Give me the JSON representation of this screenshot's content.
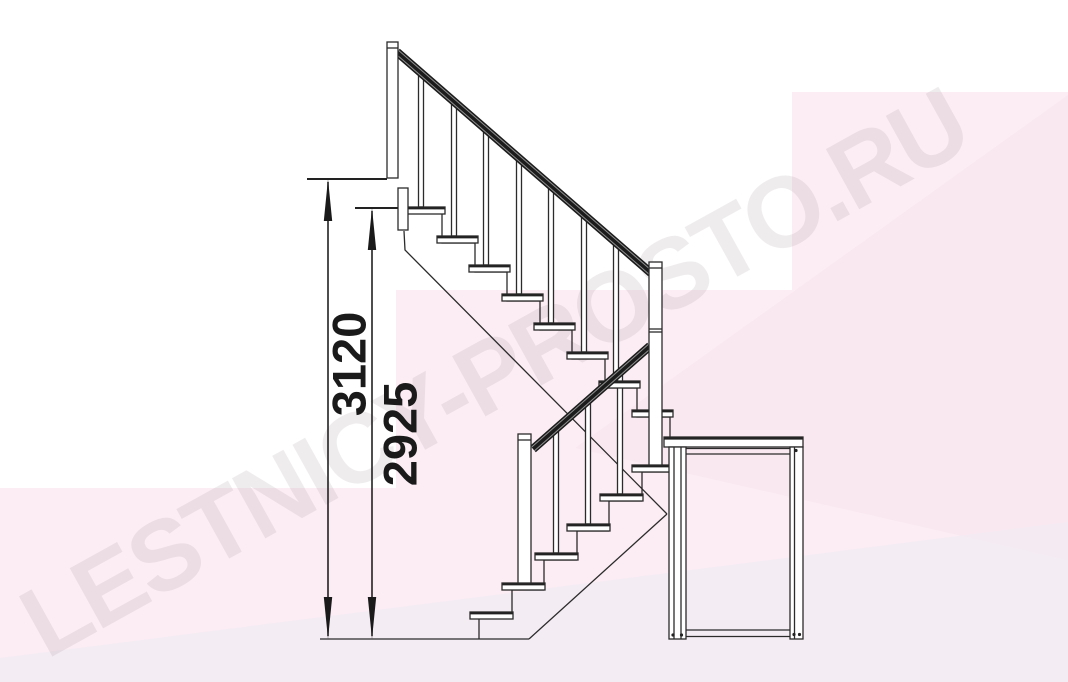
{
  "watermark": {
    "text": "LESTNICY-PROSTO.RU"
  },
  "dimensions": {
    "floor_to_floor_height": {
      "value": "3120"
    },
    "height_to_top_tread": {
      "value": "2925"
    }
  },
  "drawing": {
    "subject": "staircase-side-elevation",
    "upper_flight": {
      "treads": 8,
      "balusters": 7,
      "has_handrail": true
    },
    "lower_flight": {
      "treads": 6,
      "balusters": 3,
      "has_handrail": true
    },
    "landing_platform": {
      "legs": 2
    },
    "posts": [
      "top-newel-post",
      "central-newel-post",
      "lower-newel-post"
    ]
  },
  "colors": {
    "background_pink": "#fcedf4",
    "background_pink_deep": "#f8e3ed",
    "background_lavender": "#f2ebf2",
    "outline": "#2b2b2b",
    "handrail": "#1b1b1b",
    "dimension_text": "#1a1a1a",
    "watermark_text": "rgba(128,106,120,0.13)"
  }
}
